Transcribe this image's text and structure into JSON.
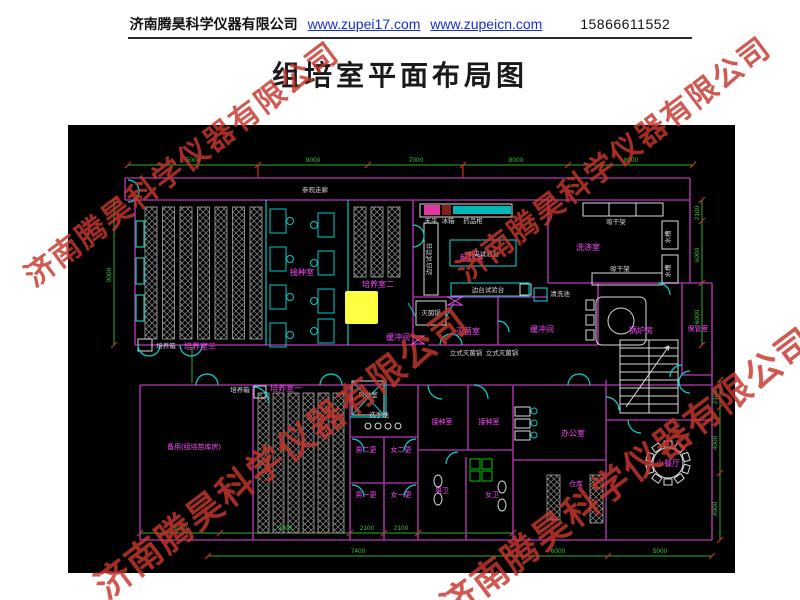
{
  "header": {
    "company": "济南腾昊科学仪器有限公司",
    "link1": "www.zupei17.com",
    "link2": "www.zupeicn.com",
    "phone": "15866611552"
  },
  "title": "组培室平面布局图",
  "watermark": {
    "text": "济南腾昊科学仪器有限公司",
    "color": "#c6372c"
  },
  "plan": {
    "corridor": "参观走廊",
    "room_labels": [
      "培养室三",
      "接种室",
      "培养室二",
      "缓冲间",
      "配药室",
      "洗涤室",
      "灭菌室",
      "缓冲间",
      "锅炉房",
      "保管室",
      "备用(组培苗库房)",
      "培养室一",
      "男二更",
      "女二更",
      "男一更",
      "女一更",
      "接种室",
      "接种室",
      "男卫",
      "女卫",
      "办公室",
      "仓库",
      "小餐厅"
    ],
    "equip_labels": [
      "培养箱",
      "培养箱",
      "中央试验台",
      "边台试验台",
      "边台试验台",
      "天平",
      "冰箱",
      "药品柜",
      "灭菌锅",
      "立式灭菌锅",
      "立式灭菌锅",
      "晾干架",
      "晾干架",
      "水槽",
      "水槽",
      "风淋室",
      "洗手池",
      "清洗池"
    ],
    "dims": {
      "top": [
        "5000",
        "9000",
        "7000",
        "8000",
        "8000"
      ],
      "left": [
        "9000"
      ],
      "right_upper": [
        "2100",
        "6000",
        "6000"
      ],
      "right_lower": [
        "2100",
        "4000",
        "4000"
      ],
      "bottom": [
        "5000",
        "9000",
        "2100",
        "2100",
        "7400",
        "6000",
        "5000"
      ]
    },
    "colors": {
      "background": "#000000",
      "wall": "#9b2f9b",
      "fixture": "#00cccc",
      "room_label": "#ff46ff",
      "equipment_label": "#dadada",
      "dimension": "#35c035",
      "tick": "#d03020",
      "highlight": "#ffff42",
      "stall": "#00c800"
    }
  }
}
